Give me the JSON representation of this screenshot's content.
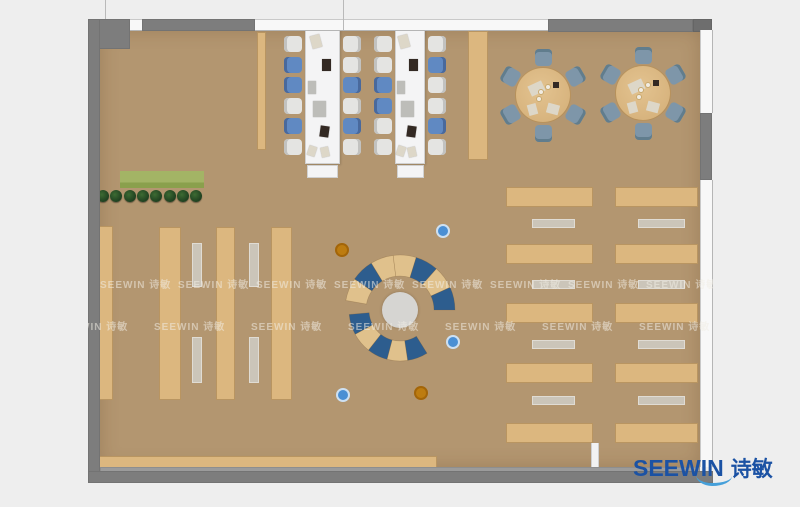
{
  "page": {
    "bg": "#eeeeee",
    "width": 800,
    "height": 507
  },
  "logo": {
    "text_en": "SEEWIN",
    "text_cn": "诗敏",
    "color": "#1b52a4",
    "swoosh_color": "#46a0da"
  },
  "watermark": {
    "text": "SEEWIN 诗敏",
    "color": "rgba(240,236,228,0.55)",
    "font_size": 10,
    "layer": {
      "x": 88,
      "y": 19,
      "w": 625,
      "h": 464
    },
    "rows": [
      {
        "y": 257,
        "start_x": 12,
        "spacing": 78,
        "count": 8
      },
      {
        "y": 299,
        "start_x": -31,
        "spacing": 97,
        "count": 7
      }
    ]
  },
  "palette": {
    "floor": "#b39670",
    "wood": "#dcb77f",
    "bench": "#cdc8be",
    "wall": "#7d7d7d",
    "wall_dark": "#6e6e6e",
    "wall_lip": "#9b9b9b",
    "window": "#f8f8f8",
    "table_white": "#f4f4f5",
    "chair_white": "#e4e4e2",
    "chair_white_edge": "#c2c2c0",
    "chair_blue": "#6089c2",
    "chair_blue_edge": "#49699c",
    "chair_steel": "#7e96a9",
    "chair_steel_edge": "#617d8d",
    "arc_blue": "#2d5d8e",
    "arc_tan": "#e0c18c",
    "circle_gray": "#d6d5d2",
    "pouf_blue": "#4a8fd4",
    "pouf_blue_ring": "#cde0f2",
    "pouf_orange": "#bd7c10",
    "pouf_orange_ring": "#a36508",
    "round_table": "#d7b37d",
    "planter_light": "#a3b465",
    "planter_dark": "#8aa04c",
    "bush": "#1f4020",
    "item_dark": "#332923",
    "item_paper": "#ddd7c8",
    "item_gray": "#bdbdb9",
    "partition": "#f2f2f2"
  },
  "room": {
    "floor": {
      "x": 100,
      "y": 30,
      "w": 600,
      "h": 437
    },
    "walls": [
      {
        "x": 88,
        "y": 19,
        "w": 42,
        "h": 30,
        "tone": "wall"
      },
      {
        "x": 142,
        "y": 19,
        "w": 113,
        "h": 12,
        "tone": "wall"
      },
      {
        "x": 548,
        "y": 19,
        "w": 145,
        "h": 13,
        "tone": "wall"
      },
      {
        "x": 693,
        "y": 19,
        "w": 19,
        "h": 13,
        "tone": "wall_dark"
      },
      {
        "x": 88,
        "y": 19,
        "w": 12,
        "h": 464,
        "tone": "wall"
      },
      {
        "x": 700,
        "y": 113,
        "w": 12,
        "h": 67,
        "tone": "wall"
      },
      {
        "x": 100,
        "y": 467,
        "w": 600,
        "h": 5,
        "tone": "wall_lip"
      },
      {
        "x": 88,
        "y": 471,
        "w": 625,
        "h": 12,
        "tone": "wall"
      }
    ],
    "windows": [
      {
        "x": 130,
        "y": 19,
        "w": 12,
        "h": 12,
        "o": "h"
      },
      {
        "x": 255,
        "y": 19,
        "w": 293,
        "h": 12,
        "o": "h"
      },
      {
        "x": 700,
        "y": 30,
        "w": 13,
        "h": 83,
        "o": "v"
      },
      {
        "x": 700,
        "y": 180,
        "w": 13,
        "h": 287,
        "o": "v"
      }
    ],
    "ticks": [
      {
        "x": 105,
        "y": 0,
        "h": 19
      },
      {
        "x": 343,
        "y": 0,
        "h": 30
      }
    ]
  },
  "furniture": {
    "planter": {
      "box": {
        "x": 120,
        "y": 171,
        "w": 84,
        "h": 17
      },
      "bushes": {
        "count": 8,
        "start_x": 103,
        "step": 13.3,
        "y": 196,
        "r": 6
      }
    },
    "shelves": [
      {
        "x": 97,
        "y": 226,
        "w": 16,
        "h": 174
      },
      {
        "x": 159,
        "y": 227,
        "w": 22,
        "h": 173
      },
      {
        "x": 216,
        "y": 227,
        "w": 19,
        "h": 173
      },
      {
        "x": 271,
        "y": 227,
        "w": 21,
        "h": 173
      }
    ],
    "shelf_benches": [
      {
        "x": 192,
        "y": 243,
        "w": 10,
        "h": 44
      },
      {
        "x": 192,
        "y": 337,
        "w": 10,
        "h": 46
      },
      {
        "x": 249,
        "y": 243,
        "w": 10,
        "h": 44
      },
      {
        "x": 249,
        "y": 337,
        "w": 10,
        "h": 46
      }
    ],
    "flank_strips": [
      {
        "x": 257,
        "y": 32,
        "w": 9,
        "h": 118
      },
      {
        "x": 468,
        "y": 31,
        "w": 20,
        "h": 129
      }
    ],
    "counter": {
      "x": 98,
      "y": 456,
      "w": 339,
      "h": 14
    },
    "partition": {
      "x": 591,
      "y": 443,
      "w": 8,
      "h": 26
    },
    "workstations": {
      "chair": {
        "w": 18,
        "h": 16,
        "start_y": 36,
        "step": 20.5,
        "left_dx": -21,
        "right_dx": 3
      },
      "tables": [
        {
          "x": 305,
          "y": 29,
          "w": 35,
          "h": 135,
          "end": {
            "x": 307,
            "y": 165,
            "w": 31,
            "h": 13
          },
          "chairs_left": [
            "w",
            "b",
            "b",
            "w",
            "b",
            "w"
          ],
          "chairs_right": [
            "w",
            "w",
            "b",
            "w",
            "b",
            "w"
          ]
        },
        {
          "x": 395,
          "y": 29,
          "w": 30,
          "h": 135,
          "end": {
            "x": 397,
            "y": 165,
            "w": 27,
            "h": 13
          },
          "chairs_left": [
            "w",
            "w",
            "b",
            "b",
            "w",
            "w"
          ],
          "chairs_right": [
            "w",
            "b",
            "w",
            "w",
            "b",
            "w"
          ]
        }
      ],
      "items": [
        {
          "fx": 0.3,
          "y": 6,
          "w": 10,
          "h": 13,
          "c": "item_paper",
          "rot": -15
        },
        {
          "fx": 0.6,
          "y": 30,
          "w": 9,
          "h": 12,
          "c": "item_dark",
          "rot": 0
        },
        {
          "fx": 0.2,
          "y": 52,
          "w": 8,
          "h": 13,
          "c": "item_gray",
          "rot": 0
        },
        {
          "fx": 0.42,
          "y": 72,
          "w": 13,
          "h": 16,
          "c": "item_gray",
          "rot": 0
        },
        {
          "fx": 0.55,
          "y": 97,
          "w": 9,
          "h": 11,
          "c": "item_dark",
          "rot": 8
        },
        {
          "fx": 0.2,
          "y": 117,
          "w": 8,
          "h": 10,
          "c": "item_paper",
          "rot": 18
        },
        {
          "fx": 0.58,
          "y": 118,
          "w": 8,
          "h": 10,
          "c": "item_paper",
          "rot": -12
        }
      ]
    },
    "round_tables": {
      "r": 28,
      "chair_dist": 38,
      "chair_size": 17,
      "angles": [
        90,
        30,
        330,
        270,
        210,
        150
      ],
      "tables": [
        {
          "cx": 543,
          "cy": 95
        },
        {
          "cx": 643,
          "cy": 93
        }
      ],
      "items": [
        {
          "dx": -14,
          "dy": -12,
          "w": 15,
          "h": 11,
          "c": "item_paper",
          "rot": -25
        },
        {
          "dx": 4,
          "dy": 9,
          "w": 12,
          "h": 10,
          "c": "item_paper",
          "rot": 15
        },
        {
          "dx": -16,
          "dy": 10,
          "w": 11,
          "h": 9,
          "c": "item_paper",
          "rot": 75
        },
        {
          "dx": 10,
          "dy": -13,
          "w": 6,
          "h": 6,
          "c": "item_dark",
          "rot": 0
        }
      ],
      "plates": [
        {
          "dx": -2,
          "dy": -3
        },
        {
          "dx": 5,
          "dy": -8
        },
        {
          "dx": -4,
          "dy": 4
        }
      ]
    },
    "study_area": {
      "cols": [
        {
          "x": 506,
          "w": 87,
          "bench_x": 532,
          "bench_w": 43
        },
        {
          "x": 615,
          "w": 83,
          "bench_x": 638,
          "bench_w": 47
        }
      ],
      "desk_ys": [
        187,
        244,
        303,
        363,
        423
      ],
      "desk_h": 20,
      "bench_ys": [
        219,
        280,
        340,
        396
      ],
      "bench_h": 9
    },
    "collab_circle": {
      "cx": 400,
      "cy": 310,
      "center_r": 18,
      "arcs": [
        {
          "r_out": 55,
          "r_in": 34,
          "t1": -170,
          "t2": 0,
          "segments": [
            "tan",
            "blue",
            "tan",
            "tan",
            "blue",
            "tan",
            "blue"
          ]
        },
        {
          "r_out": 51,
          "r_in": 31,
          "t1": 58,
          "t2": 175,
          "segments": [
            "blue",
            "tan",
            "blue",
            "tan",
            "blue"
          ]
        }
      ]
    },
    "poufs": [
      {
        "x": 443,
        "y": 231,
        "c": "blue"
      },
      {
        "x": 342,
        "y": 250,
        "c": "orange"
      },
      {
        "x": 453,
        "y": 342,
        "c": "blue"
      },
      {
        "x": 343,
        "y": 395,
        "c": "blue"
      },
      {
        "x": 421,
        "y": 393,
        "c": "orange"
      }
    ],
    "pouf_r": 7
  }
}
